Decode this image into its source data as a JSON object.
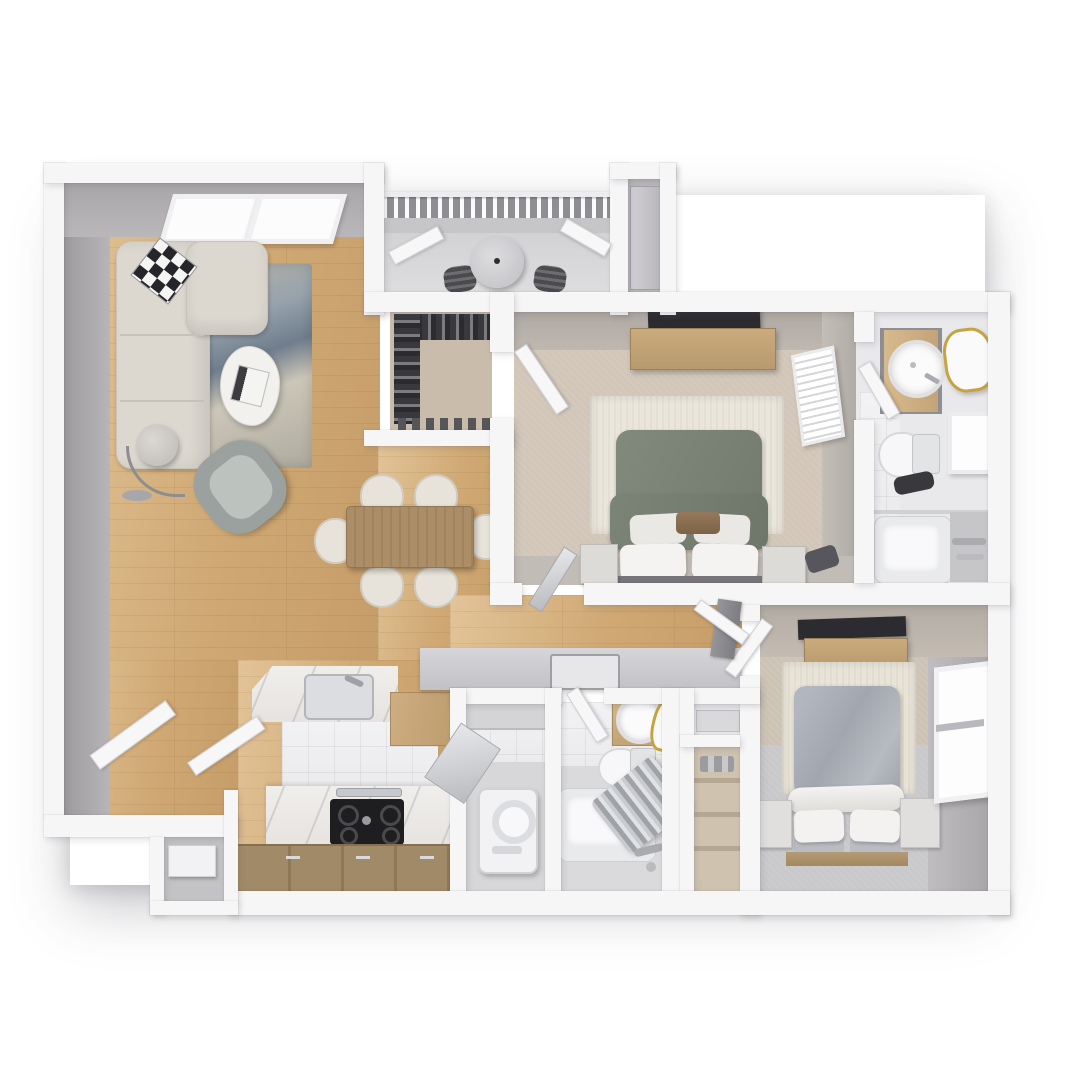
{
  "meta": {
    "label": "3D rendered top-down floor plan of a two-bedroom apartment"
  },
  "palette": {
    "wall": "#f6f6f7",
    "wallFaceDark": "#a29fa2",
    "wallFaceMid": "#b6b3b6",
    "woodLight": "#e2c498",
    "woodDark": "#c69d69",
    "cabinetWood": "#9c8564",
    "furnitureWood": "#c2a277",
    "tableWood": "#a98c66",
    "carpetBeige": "#d1c6b8",
    "carpetGray": "#c9c8ca",
    "balconyFloor": "#d9d9db",
    "rugCream": "#eae6db",
    "rugBlueGray": "#8d99a4",
    "sofaCream": "#dcd8d0",
    "duvetGreen": "#7b8476",
    "duvetGray": "#a9aeb6",
    "accentBrown": "#8a6e50",
    "mirrorGold": "#c8a23f",
    "applianceDark": "#1e1e21",
    "metal": "#b9bbbf",
    "tileWhite": "#f1f1f3"
  },
  "rooms": [
    {
      "id": "living-room",
      "furniture": [
        "l-shaped-sofa",
        "checkered-pillow",
        "area-rug",
        "coffee-table",
        "book",
        "arc-floor-lamp",
        "accent-chair",
        "skylight-window",
        "skylight-window"
      ]
    },
    {
      "id": "balcony",
      "furniture": [
        "railing",
        "round-table",
        "patio-chair",
        "patio-chair",
        "french-door",
        "french-door"
      ]
    },
    {
      "id": "walk-in-closet",
      "furniture": [
        "hanging-clothes-rod",
        "hanging-clothes-rod",
        "shoe-row"
      ]
    },
    {
      "id": "storage-closet",
      "furniture": [
        "water-heater-unit",
        "closet-door"
      ]
    },
    {
      "id": "bedroom-1",
      "furniture": [
        "queen-bed-green-duvet",
        "pillows",
        "accent-pillow",
        "nightstand",
        "nightstand",
        "dresser",
        "wall-tv",
        "cream-rug",
        "window-blinds",
        "entry-door",
        "closet-door",
        "ensuite-door"
      ]
    },
    {
      "id": "bathroom-1",
      "furniture": [
        "wood-vanity",
        "round-sink",
        "gold-rim-mirror",
        "toilet",
        "window",
        "bathtub",
        "shower-rod",
        "shower-fixtures",
        "floor-caddy"
      ]
    },
    {
      "id": "dining-area",
      "furniture": [
        "wood-dining-table",
        "dining-chair",
        "dining-chair",
        "dining-chair",
        "dining-chair",
        "dining-chair",
        "dining-chair"
      ]
    },
    {
      "id": "kitchen",
      "furniture": [
        "marble-island",
        "island-sink",
        "faucet",
        "refrigerator",
        "dishwasher-open-door",
        "marble-counter",
        "gas-cooktop",
        "oven-handle",
        "base-cabinets"
      ]
    },
    {
      "id": "entry",
      "furniture": [
        "front-door",
        "closet-door",
        "shoe-cabinet-alcove"
      ]
    },
    {
      "id": "hallway",
      "furniture": [
        "half-wall-counter",
        "counter-sink-inset",
        "closet-door",
        "gray-door-leaf"
      ]
    },
    {
      "id": "laundry",
      "furniture": [
        "washer",
        "upper-cabinet"
      ]
    },
    {
      "id": "bathroom-2",
      "furniture": [
        "wood-vanity",
        "round-sink",
        "gold-rim-mirror",
        "toilet",
        "bathtub",
        "shower-curtain",
        "shower-fixtures",
        "door"
      ]
    },
    {
      "id": "hall-closets",
      "furniture": [
        "upper-closet-shelf",
        "linen-closet-shelves"
      ]
    },
    {
      "id": "bedroom-2",
      "furniture": [
        "queen-bed-gray-duvet",
        "rolled-blanket",
        "pillows",
        "nightstand",
        "nightstand",
        "floating-shelf",
        "wall-tv",
        "cream-rug",
        "double-hung-window",
        "entry-door"
      ]
    }
  ]
}
